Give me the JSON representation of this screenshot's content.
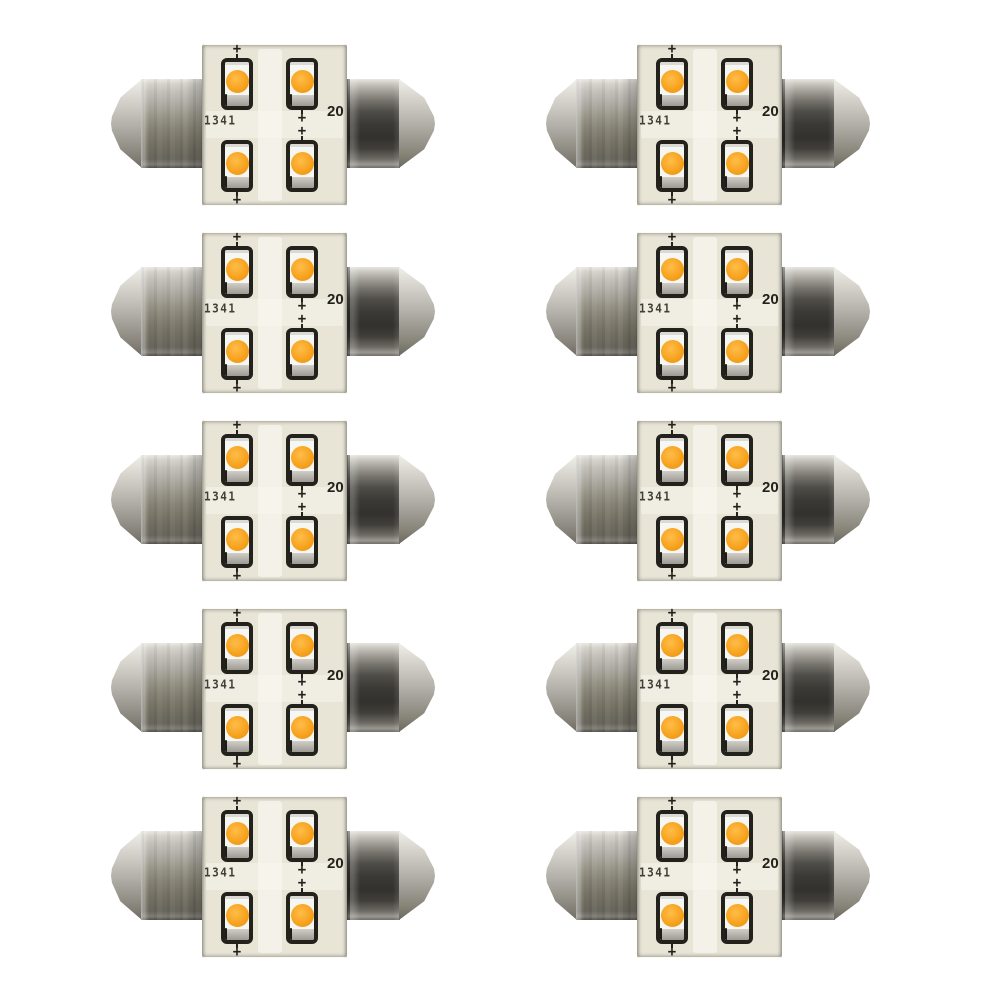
{
  "scene": {
    "subject": "festoon-led-bulb-pack",
    "background": "#ffffff",
    "grid": {
      "rows": 5,
      "columns": 2,
      "bulb_count": 10
    }
  },
  "bulb": {
    "leds_per_bulb": 4,
    "markings": {
      "left_code": "1341",
      "right_code": "20",
      "polarity": "+"
    },
    "colors": {
      "background": "#ffffff",
      "pcb": "#e8e5d7",
      "pcb_trace": "#f8f6ee",
      "led_amber": "#f7a31e",
      "led_amber_bright": "#ffbd4a",
      "led_amber_deep": "#e88d0e",
      "led_body": "#f6f6f2",
      "led_outline": "#23211c",
      "electrode_metal": "#b9b7b0",
      "cap_light": "#eceae4",
      "cap_mid": "#878377",
      "cap_dark": "#32312d",
      "marking_ink": "#23211b"
    }
  }
}
